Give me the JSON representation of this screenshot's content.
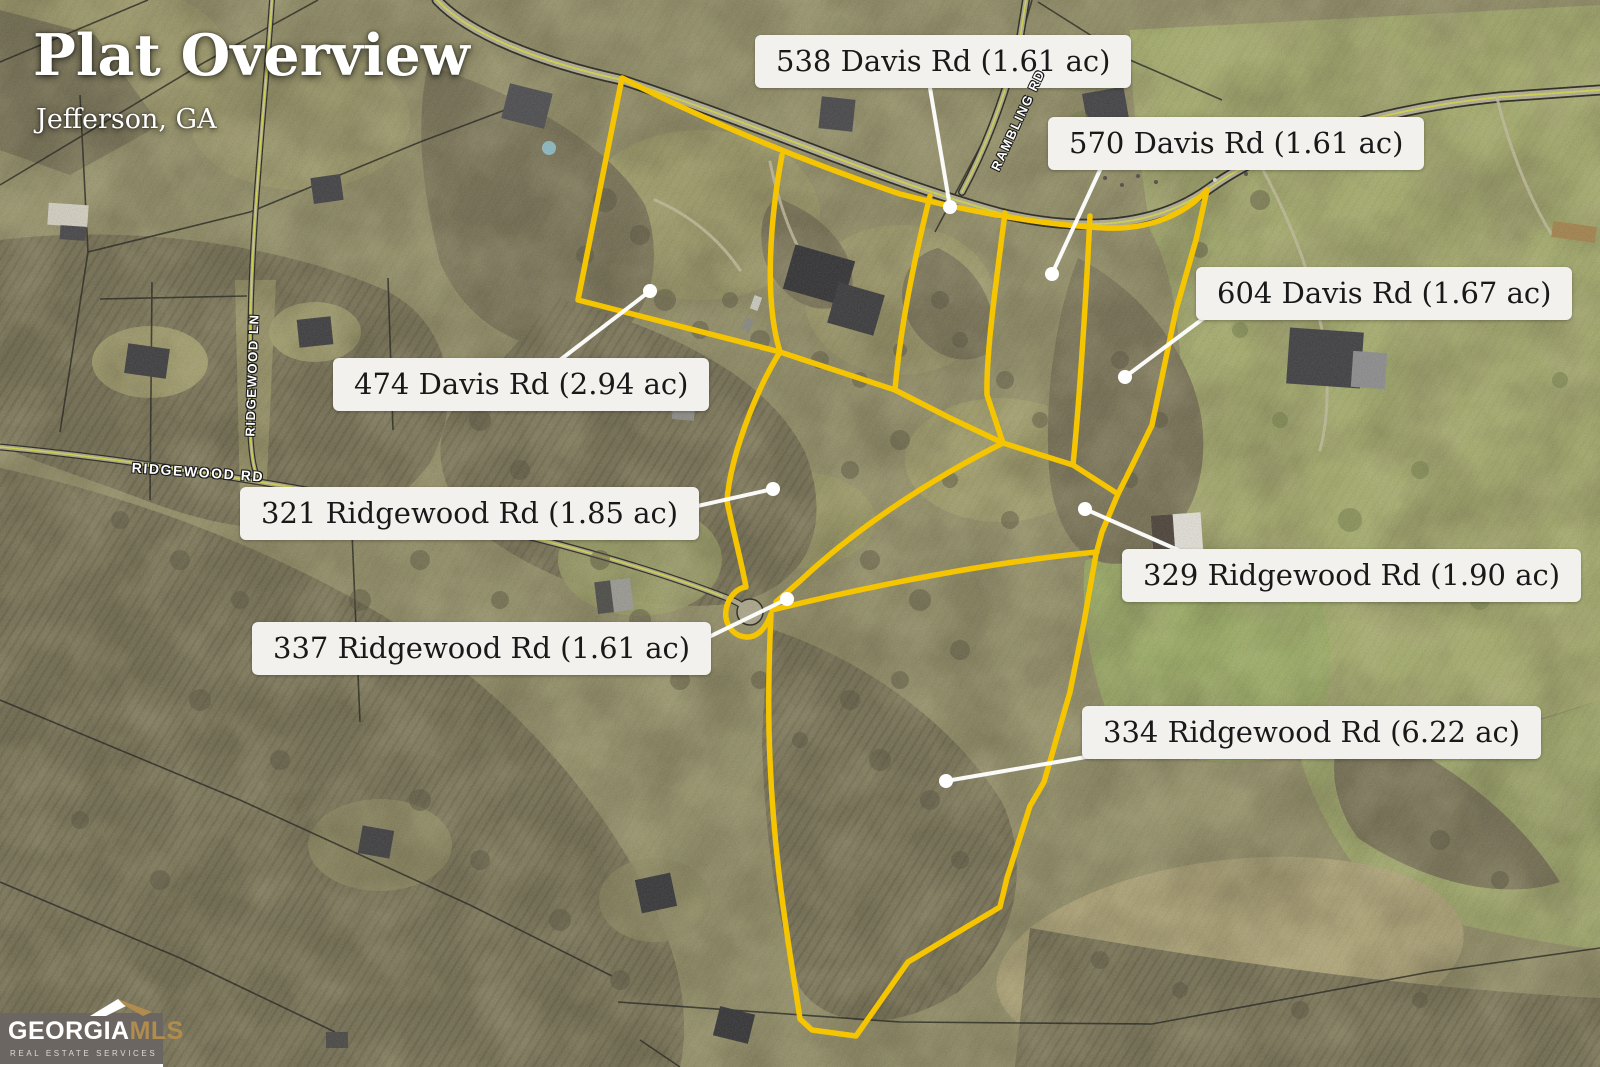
{
  "header": {
    "title": "Plat Overview",
    "subtitle": "Jefferson, GA"
  },
  "parcels": [
    {
      "label": "538 Davis Rd (1.61 ac)"
    },
    {
      "label": "570 Davis Rd (1.61 ac)"
    },
    {
      "label": "604 Davis Rd (1.67 ac)"
    },
    {
      "label": "474 Davis Rd (2.94 ac)"
    },
    {
      "label": "321 Ridgewood Rd (1.85 ac)"
    },
    {
      "label": "329 Ridgewood Rd (1.90 ac)"
    },
    {
      "label": "337 Ridgewood Rd (1.61 ac)"
    },
    {
      "label": "334 Ridgewood Rd (6.22 ac)"
    }
  ],
  "roads": [
    {
      "name": "RIDGEWOOD LN"
    },
    {
      "name": "RIDGEWOOD RD"
    },
    {
      "name": "RAMBLING RD"
    }
  ],
  "logo": {
    "name_primary": "GEORGIA",
    "name_accent": "MLS",
    "tagline": "REAL ESTATE SERVICES"
  },
  "colors": {
    "plat_line": "#F4C500",
    "leader": "#FFFFFF",
    "label_bg": "#F2F1EE",
    "label_text": "#191919",
    "logo_bg": "#6B6661",
    "logo_gold": "#B08C4E"
  }
}
